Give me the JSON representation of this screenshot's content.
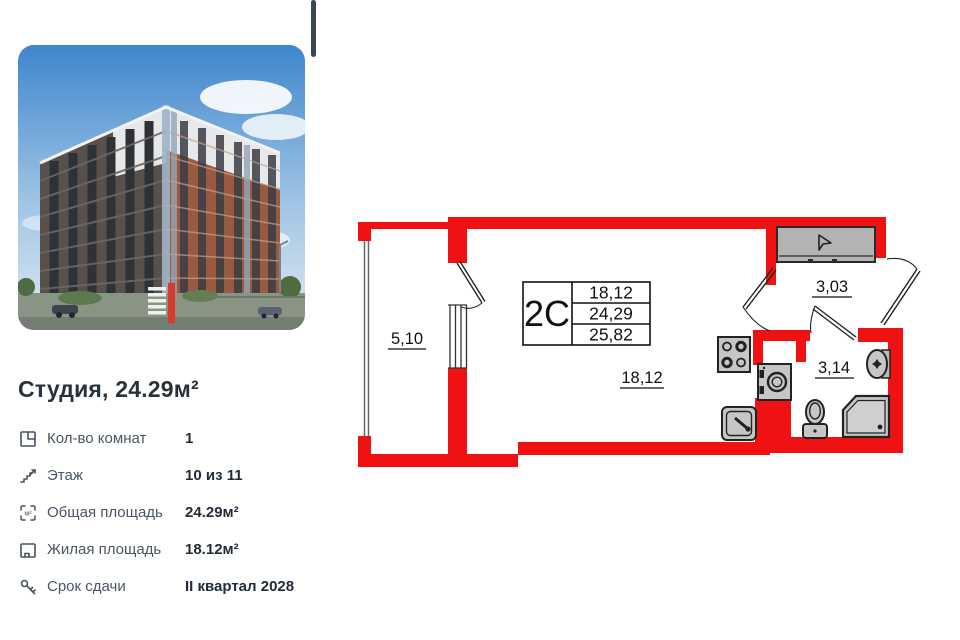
{
  "listing": {
    "title": "Студия, 24.29м²",
    "details": [
      {
        "icon": "rooms-icon",
        "label": "Кол-во комнат",
        "value": "1"
      },
      {
        "icon": "stairs-icon",
        "label": "Этаж",
        "value": "10 из 11"
      },
      {
        "icon": "total-area-icon",
        "label": "Общая площадь",
        "value": "24.29м²"
      },
      {
        "icon": "living-area-icon",
        "label": "Жилая площадь",
        "value": "18.12м²"
      },
      {
        "icon": "key-icon",
        "label": "Срок сдачи",
        "value": "II квартал 2028"
      }
    ]
  },
  "floorplan": {
    "unit_label": "2С",
    "area_living": "18,12",
    "area_total": "24,29",
    "area_with_balcony": "25,82",
    "rooms": {
      "balcony": "5,10",
      "main_room": "18,12",
      "hallway": "3,03",
      "bathroom": "3,14"
    },
    "fixtures": [
      "wardrobe",
      "stove",
      "kitchen-sink",
      "washing-machine",
      "toilet",
      "shower",
      "washbasin"
    ],
    "colors": {
      "wall": "#f01212",
      "fixture_fill": "#c6c6c6",
      "line": "#111111"
    }
  }
}
